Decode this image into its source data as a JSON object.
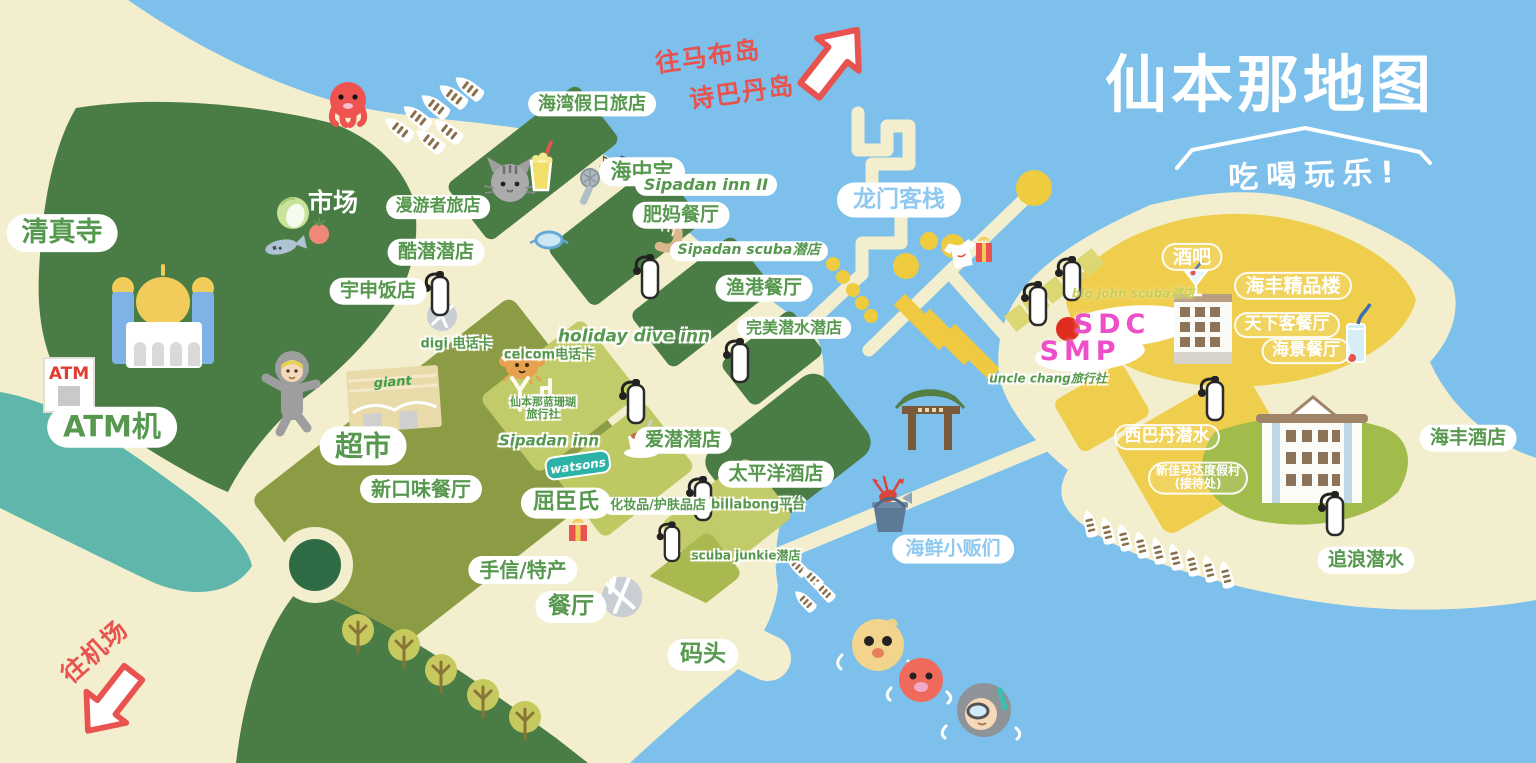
{
  "title": {
    "main": "仙本那地图",
    "subtitle": "吃喝玩乐!"
  },
  "colors": {
    "sea": "#7CC0EB",
    "sand": "#F3EFCE",
    "island_green": "#4A7D45",
    "olive": "#8C9C44",
    "light_green": "#C2CB69",
    "teal_water": "#5FB7AB",
    "yellow_island": "#F0CE4D",
    "label_green": "#56984E",
    "label_blue": "#8FC9F0",
    "accent_red": "#E8524F",
    "accent_magenta": "#EC4FC8",
    "watsons_teal": "#2AB3A6"
  },
  "signs": {
    "atm": "ATM",
    "giant": "giant",
    "watsons": "watsons",
    "notes": "♪ ♫"
  },
  "directions": [
    {
      "id": "to-mabul",
      "text": "往马布岛 诗巴丹岛",
      "arrow": "up-right"
    },
    {
      "id": "to-airport",
      "text": "往机场",
      "arrow": "down-left"
    }
  ],
  "markers": [
    {
      "id": "sdc",
      "text": "SDC",
      "dot": "red"
    },
    {
      "id": "smp",
      "text": "SMP"
    }
  ],
  "icons": [
    "octopus-icon",
    "boat-icon",
    "cat-icon",
    "milkshake-icon",
    "microphone-icon",
    "music-notes-icon",
    "shrimp-icon",
    "cabbage-icon",
    "tomato-icon",
    "fish-icon",
    "dive-goggles-icon",
    "scuba-tank-icon",
    "mosque-illustration",
    "atm-booth",
    "diver-character",
    "supermarket-building",
    "crab-icon",
    "signal-tower-icon",
    "teacup-icon",
    "gift-box-icon",
    "tshirt-icon",
    "plate-cutlery-icon",
    "tree-icon",
    "roundabout",
    "chinese-gate",
    "lobster-bucket-icon",
    "duck-swimmer-icon",
    "octopus-swimmer-icon",
    "snorkeler-icon",
    "hotel-building",
    "resort-building",
    "martini-icon",
    "tall-drink-icon",
    "buoy-icon",
    "dock-slab",
    "location-dot",
    "direction-arrow-icon"
  ],
  "labels": [
    {
      "id": "qingzhensi",
      "t": "清真寺",
      "x": 62,
      "y": 233,
      "fs": 27,
      "st": "gb"
    },
    {
      "id": "atm-ji",
      "t": "ATM机",
      "x": 112,
      "y": 427,
      "fs": 29,
      "st": "gb"
    },
    {
      "id": "shichang",
      "t": "市场",
      "x": 333,
      "y": 203,
      "fs": 25,
      "st": "ws"
    },
    {
      "id": "manyouzhe",
      "t": "漫游者旅店",
      "x": 438,
      "y": 207,
      "fs": 17,
      "st": "gb"
    },
    {
      "id": "kuqian",
      "t": "酷潜潜店",
      "x": 436,
      "y": 252,
      "fs": 19,
      "st": "gb"
    },
    {
      "id": "yushen",
      "t": "宇申饭店",
      "x": 378,
      "y": 291,
      "fs": 19,
      "st": "gb"
    },
    {
      "id": "haiwan",
      "t": "海湾假日旅店",
      "x": 592,
      "y": 104,
      "fs": 18,
      "st": "gb"
    },
    {
      "id": "haizhongbao",
      "t": "海中宝",
      "x": 642,
      "y": 172,
      "fs": 21,
      "st": "gb"
    },
    {
      "id": "sipadan-inn-2",
      "t": "Sipadan inn II",
      "x": 706,
      "y": 185,
      "fs": 16,
      "st": "gb",
      "it": 1
    },
    {
      "id": "feima",
      "t": "肥妈餐厅",
      "x": 681,
      "y": 215,
      "fs": 19,
      "st": "gb"
    },
    {
      "id": "sipadan-scuba",
      "t": "Sipadan scuba潜店",
      "x": 749,
      "y": 251,
      "fs": 14,
      "st": "gb",
      "it": 1
    },
    {
      "id": "yugang",
      "t": "渔港餐厅",
      "x": 764,
      "y": 288,
      "fs": 19,
      "st": "gb"
    },
    {
      "id": "holiday-dive-inn",
      "t": "holiday dive inn",
      "x": 634,
      "y": 337,
      "fs": 17,
      "st": "gs",
      "it": 1
    },
    {
      "id": "wanmei",
      "t": "完美潜水潜店",
      "x": 794,
      "y": 328,
      "fs": 16,
      "st": "gb"
    },
    {
      "id": "digi",
      "t": "digi 电话卡",
      "x": 456,
      "y": 345,
      "fs": 13,
      "st": "gs"
    },
    {
      "id": "celcom",
      "t": "celcom电话卡",
      "x": 549,
      "y": 356,
      "fs": 13,
      "st": "gs"
    },
    {
      "id": "lanshanhu",
      "lines": [
        "仙本那蓝珊瑚",
        "旅行社"
      ],
      "x": 543,
      "y": 409,
      "fs": 11,
      "st": "gs"
    },
    {
      "id": "sipadan-inn",
      "t": "Sipadan inn",
      "x": 549,
      "y": 441,
      "fs": 15,
      "st": "gs",
      "it": 1
    },
    {
      "id": "quchenshi",
      "t": "屈臣氏",
      "x": 566,
      "y": 503,
      "fs": 22,
      "st": "gb"
    },
    {
      "id": "huazhuangpin",
      "t": "化妆品/护肤品店",
      "x": 658,
      "y": 506,
      "fs": 13,
      "st": "gb"
    },
    {
      "id": "aiqian",
      "t": "爱潜潜店",
      "x": 683,
      "y": 440,
      "fs": 19,
      "st": "gb"
    },
    {
      "id": "chaoshi",
      "t": "超市",
      "x": 363,
      "y": 446,
      "fs": 28,
      "st": "gb"
    },
    {
      "id": "xinkouwei",
      "t": "新口味餐厅",
      "x": 421,
      "y": 489,
      "fs": 20,
      "st": "gb"
    },
    {
      "id": "shouxin",
      "t": "手信/特产",
      "x": 523,
      "y": 570,
      "fs": 20,
      "st": "gb"
    },
    {
      "id": "canting",
      "t": "餐厅",
      "x": 571,
      "y": 607,
      "fs": 23,
      "st": "gb"
    },
    {
      "id": "taipingyang",
      "t": "太平洋酒店",
      "x": 776,
      "y": 474,
      "fs": 19,
      "st": "gb"
    },
    {
      "id": "billabong",
      "t": "billabong平台",
      "x": 758,
      "y": 506,
      "fs": 13,
      "st": "gs"
    },
    {
      "id": "scuba-junkie",
      "t": "scuba junkie潜店",
      "x": 746,
      "y": 556,
      "fs": 12,
      "st": "gs"
    },
    {
      "id": "matou",
      "t": "码头",
      "x": 703,
      "y": 655,
      "fs": 23,
      "st": "gb"
    },
    {
      "id": "longmen",
      "t": "龙门客栈",
      "x": 899,
      "y": 200,
      "fs": 23,
      "st": "bb"
    },
    {
      "id": "haixian",
      "t": "海鲜小贩们",
      "x": 953,
      "y": 549,
      "fs": 19,
      "st": "bb"
    },
    {
      "id": "jiuba",
      "t": "酒吧",
      "x": 1192,
      "y": 257,
      "fs": 19,
      "st": "wo"
    },
    {
      "id": "bigjohn",
      "t": "big john scuba潜店",
      "x": 1133,
      "y": 294,
      "fs": 12,
      "st": "ys"
    },
    {
      "id": "unclechang",
      "t": "uncle chang旅行社",
      "x": 1048,
      "y": 379,
      "fs": 12,
      "st": "gs",
      "it": 1
    },
    {
      "id": "haifengjingpin",
      "t": "海丰精品楼",
      "x": 1293,
      "y": 286,
      "fs": 19,
      "st": "wo"
    },
    {
      "id": "tianxiake",
      "t": "天下客餐厅",
      "x": 1287,
      "y": 325,
      "fs": 17,
      "st": "wo"
    },
    {
      "id": "haijing",
      "t": "海景餐厅",
      "x": 1306,
      "y": 351,
      "fs": 17,
      "st": "wo"
    },
    {
      "id": "xibadan",
      "t": "西巴丹潜水",
      "x": 1167,
      "y": 437,
      "fs": 17,
      "st": "wo"
    },
    {
      "id": "xinjiamada",
      "lines": [
        "新佳马达度假村",
        "(接待处)"
      ],
      "x": 1198,
      "y": 478,
      "fs": 12,
      "st": "wo"
    },
    {
      "id": "haifengjiudian",
      "t": "海丰酒店",
      "x": 1468,
      "y": 438,
      "fs": 19,
      "st": "gb"
    },
    {
      "id": "zhuilang",
      "t": "追浪潜水",
      "x": 1366,
      "y": 560,
      "fs": 19,
      "st": "gb"
    },
    {
      "id": "sdc",
      "t": "SDC",
      "x": 1112,
      "y": 325,
      "fs": 27,
      "st": "mg"
    },
    {
      "id": "smp",
      "t": "SMP",
      "x": 1080,
      "y": 352,
      "fs": 27,
      "st": "mg"
    },
    {
      "id": "to-mabul-1",
      "t": "往马布岛",
      "x": 708,
      "y": 57,
      "fs": 25,
      "st": "red",
      "rot": -8
    },
    {
      "id": "to-mabul-2",
      "t": "诗巴丹岛",
      "x": 742,
      "y": 93,
      "fs": 25,
      "st": "red",
      "rot": -8
    },
    {
      "id": "to-airport",
      "t": "往机场",
      "x": 95,
      "y": 652,
      "fs": 25,
      "st": "red",
      "rot": -42
    }
  ]
}
